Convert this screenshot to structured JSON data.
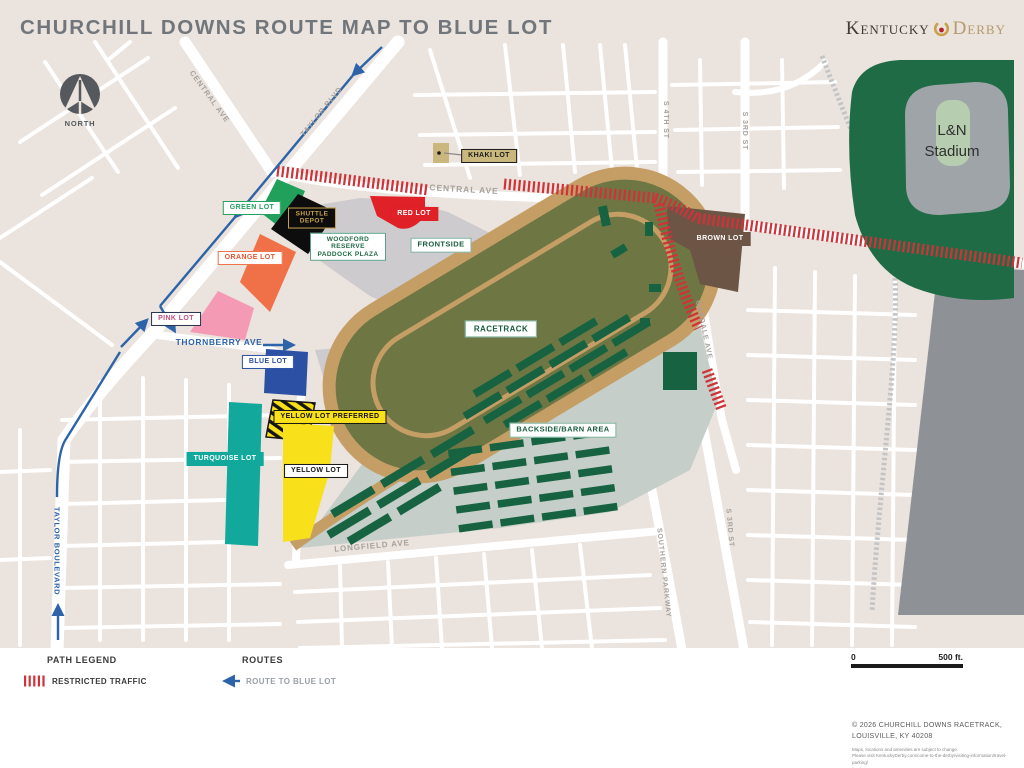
{
  "header": {
    "title": "CHURCHILL DOWNS ROUTE MAP TO BLUE LOT",
    "logo_kentucky": "Kentucky",
    "logo_derby": "Derby"
  },
  "compass": {
    "label": "NORTH"
  },
  "streets": {
    "central_ave": "CENTRAL AVE",
    "taylor_blvd": "TAYLOR BLVD",
    "taylor_boulevard": "TAYLOR BOULEVARD",
    "thornberry_ave": "THORNBERRY AVE",
    "longfield_ave": "LONGFIELD AVE",
    "southern_parkway": "SOUTHERN PARKWAY",
    "oakdale_ave": "OAKDALE AVE",
    "s_4th_st": "S 4TH ST",
    "s_3rd_st": "S 3RD ST"
  },
  "lots": {
    "khaki": "KHAKI LOT",
    "green": "GREEN LOT",
    "shuttle": "SHUTTLE DEPOT",
    "red": "RED LOT",
    "orange": "ORANGE LOT",
    "pink": "PINK LOT",
    "blue": "BLUE LOT",
    "turquoise": "TURQUOISE LOT",
    "yellow_preferred": "YELLOW LOT PREFERRED",
    "yellow": "YELLOW LOT",
    "brown": "BROWN LOT"
  },
  "areas": {
    "woodford": "WOODFORD RESERVE PADDOCK PLAZA",
    "frontside": "FRONTSIDE",
    "racetrack": "RACETRACK",
    "backside": "BACKSIDE/BARN AREA",
    "stadium_line1": "L&N",
    "stadium_line2": "Stadium"
  },
  "legend": {
    "path_title": "PATH LEGEND",
    "restricted": "RESTRICTED TRAFFIC",
    "routes_title": "ROUTES",
    "route_blue": "ROUTE TO BLUE LOT"
  },
  "scale": {
    "start": "0",
    "end": "500 ft."
  },
  "footer": {
    "copyright_line1": "© 2026 CHURCHILL DOWNS RACETRACK,",
    "copyright_line2": "LOUISVILLE, KY 40208",
    "fine_line1": "Maps, locations and amenities are subject to change.",
    "fine_line2": "Please visit KentuckyDerby.com/come-to-the-derby/visiting-information/travel-parking/",
    "fine_line3": "for the most current maps."
  },
  "colors": {
    "background_beige": "#ebe3dd",
    "route_blue": "#2d63a8",
    "restricted_red": "#cf3339",
    "track_tan": "#c59e66",
    "infield_olive": "#6e7644",
    "barn_green": "#176341",
    "stadium_green": "#1e6b45",
    "green_lot": "#21a05c",
    "orange_lot": "#f07048",
    "red_lot": "#e02127",
    "pink_lot": "#f49ab5",
    "blue_lot": "#2b50a4",
    "turquoise_lot": "#12a89b",
    "yellow_lot": "#f8e11b",
    "khaki_lot": "#c9b77e",
    "brown_lot": "#6d5546"
  }
}
